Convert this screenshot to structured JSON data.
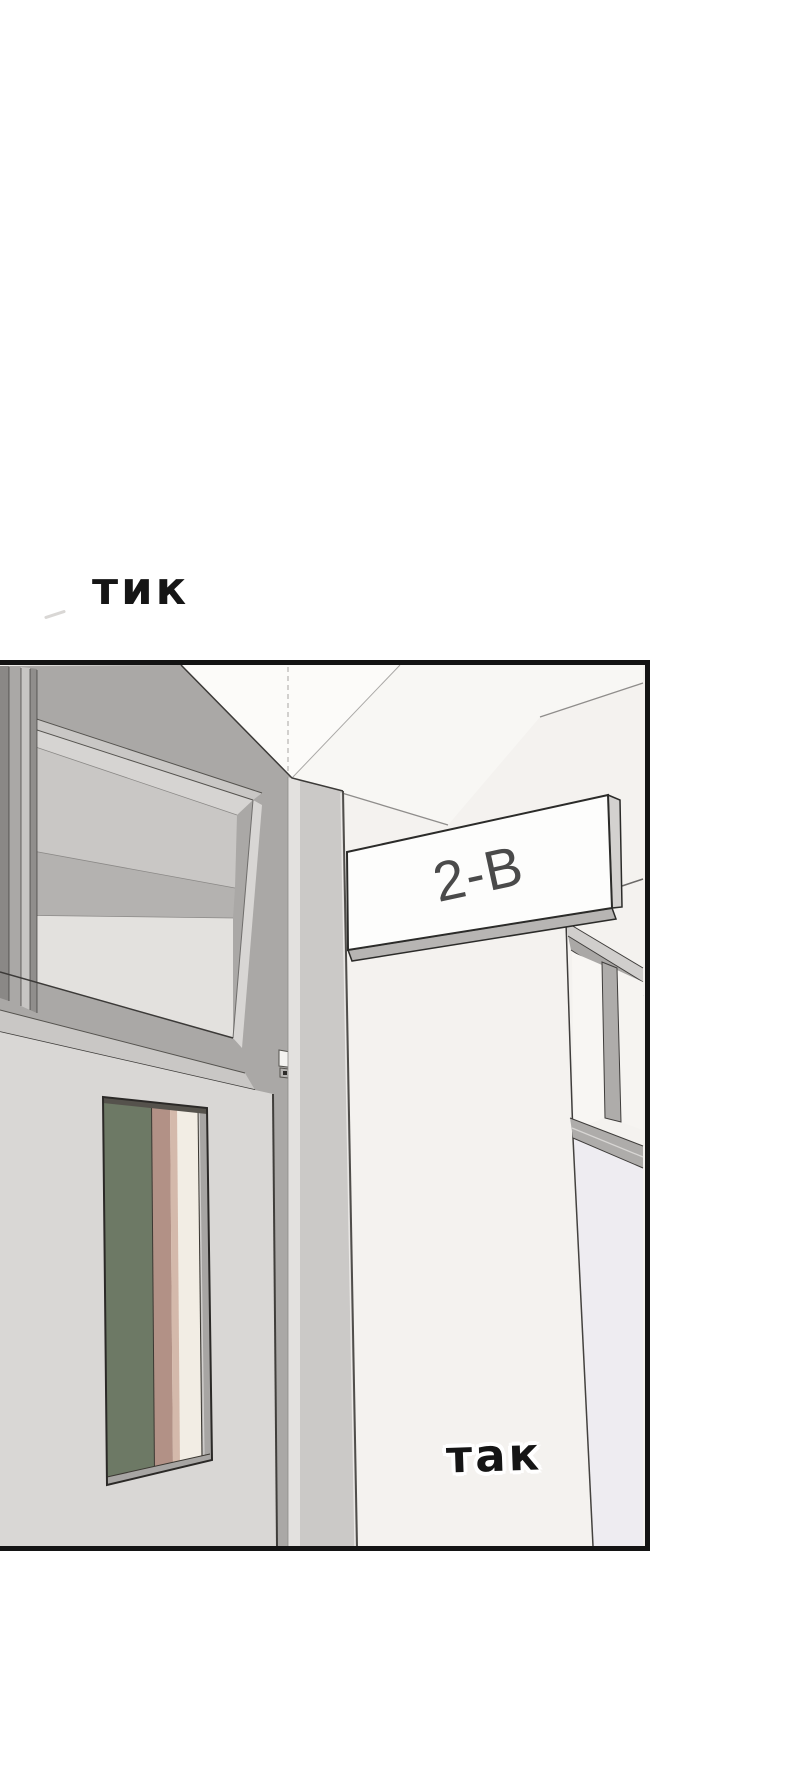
{
  "page": {
    "width": 800,
    "height": 1769,
    "background": "#ffffff"
  },
  "panel": {
    "x": 0,
    "y": 660,
    "width": 650,
    "height": 891,
    "border_color": "#141414"
  },
  "sfx": {
    "tick": "тик",
    "tock": "так"
  },
  "sign": {
    "label": "2-B"
  },
  "palette": {
    "panel_border": "#141414",
    "wall": "#f4f2ef",
    "ceiling_bright": "#fcfbf9",
    "frame_gray": "#aaa8a6",
    "frame_light": "#c9c7c5",
    "pillar": "#cbc9c7",
    "pillar_highlight": "#e3e1df",
    "door": "#d9d7d5",
    "glass_band_dark": "#b4b2b0",
    "glass_band_light": "#e3e1de",
    "door_window_green": "#6d7965",
    "door_window_tan": "#b29186",
    "door_window_cream": "#f2ede4",
    "distant_wall_tint": "#eeecf1",
    "sign_face": "#fdfdfc",
    "sign_text": "#4a4a4a",
    "sfx_text": "#151515"
  }
}
